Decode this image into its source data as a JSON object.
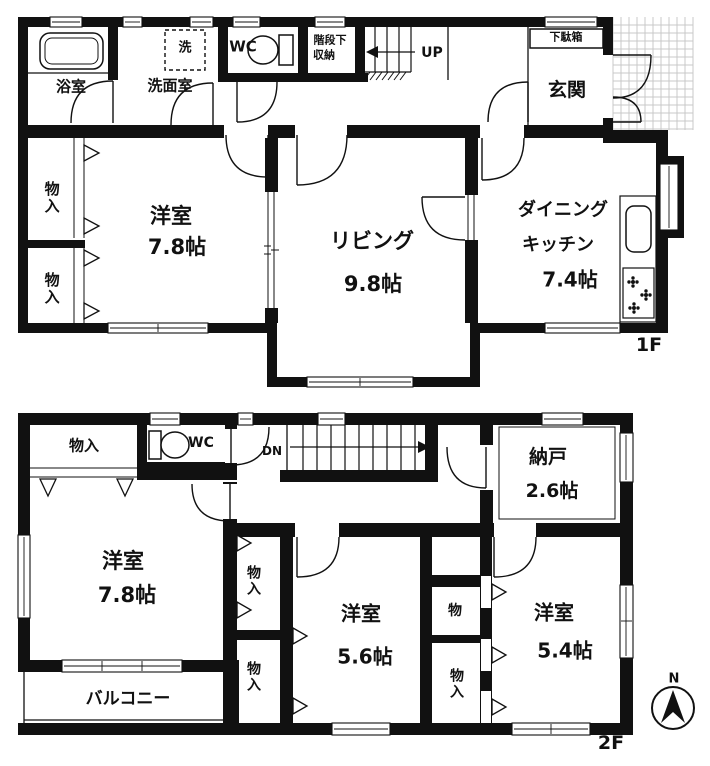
{
  "meta": {
    "floor1_label": "1F",
    "floor2_label": "2F",
    "compass_north": "N"
  },
  "f1": {
    "bathroom": "浴室",
    "washing_machine": "洗",
    "washroom": "洗面室",
    "toilet": "WC",
    "under_stairs_storage_line1": "階段下",
    "under_stairs_storage_line2": "収納",
    "stairs_up": "UP",
    "shoe_cabinet": "下駄箱",
    "entrance": "玄関",
    "closet_upper": "物入",
    "closet_lower": "物入",
    "western_room_name": "洋室",
    "western_room_size": "7.8帖",
    "living_name": "リビング",
    "living_size": "9.8帖",
    "dk_name_line1": "ダイニング",
    "dk_name_line2": "キッチン",
    "dk_size": "7.4帖"
  },
  "f2": {
    "closet_top_left": "物入",
    "toilet": "WC",
    "stairs_down": "DN",
    "storeroom_name": "納戸",
    "storeroom_size": "2.6帖",
    "western_room_a_name": "洋室",
    "western_room_a_size": "7.8帖",
    "closet_mid_upper": "物入",
    "closet_mid_lower": "物入",
    "western_room_b_name": "洋室",
    "western_room_b_size": "5.6帖",
    "closet_right_upper": "物",
    "closet_right_lower": "物入",
    "western_room_c_name": "洋室",
    "western_room_c_size": "5.4帖",
    "balcony": "バルコニー"
  },
  "colors": {
    "wall": "#111111",
    "tile_grid": "#c9c9c9",
    "background": "#ffffff"
  }
}
